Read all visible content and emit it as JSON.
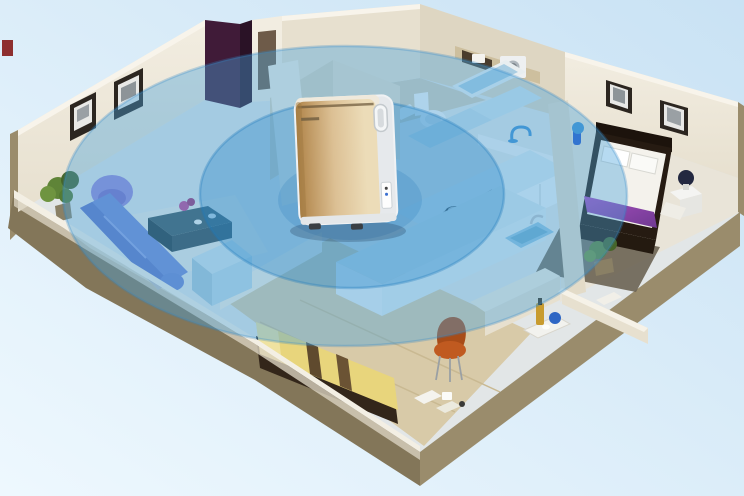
{
  "scene": {
    "type": "isometric-apartment-cutaway",
    "device": {
      "kind": "air-purifier",
      "placement": "center-of-apartment"
    },
    "coverage": {
      "rings": 2,
      "style": "translucent-blue-ellipses"
    },
    "rooms": [
      "living-room",
      "bathroom",
      "kitchen",
      "master-bedroom",
      "second-bedroom",
      "hallway"
    ]
  },
  "palette": {
    "background_top": "#c9e2f4",
    "background_bottom": "#eef8fe",
    "slab_edge": "#9a8c6c",
    "slab_edge_dark": "#837659",
    "wall_cream": "#e7e0cf",
    "wall_cream_light": "#f2ede1",
    "wall_shadow": "#d9d2bf",
    "floor_light": "#e2e6e7",
    "floor_wood": "#d8caa8",
    "floor_master": "#e9e4d8",
    "rug_light": "#eceae3",
    "sofa_blue": "#7287d2",
    "chair_purple": "#9487d8",
    "table_teal": "#344950",
    "flower_magenta": "#c2418f",
    "cabinet_blue": "#bcd7e4",
    "bed_yellow": "#e8d57c",
    "bed_stripe": "#5f4a2e",
    "chair_orange": "#c05a20",
    "bed_dark": "#261b12",
    "bedding_white": "#f4f2ec",
    "runner_purple": "#a94fc0",
    "runner_purple_dark": "#6f3a92",
    "plant_green": "#5f8438",
    "wardrobe_plum": "#401b38",
    "fixture_white": "#f2f4f5",
    "tub_blue": "#a9cde2",
    "counter_top": "#d9e8ee",
    "counter_front": "#ecf2f6",
    "lamp_blue": "#3f8fd0",
    "frame_dark": "#2c2620",
    "accent_red": "#8e2f2f",
    "coverage_outer": "#49a3dc",
    "coverage_inner": "#1f82c6",
    "coverage_core": "#1670b4",
    "purifier_gold_1": "#b08449",
    "purifier_gold_2": "#dcc094",
    "purifier_gold_3": "#ecdcb8",
    "purifier_white": "#f0f2f4",
    "purifier_seam": "#6a5638"
  }
}
